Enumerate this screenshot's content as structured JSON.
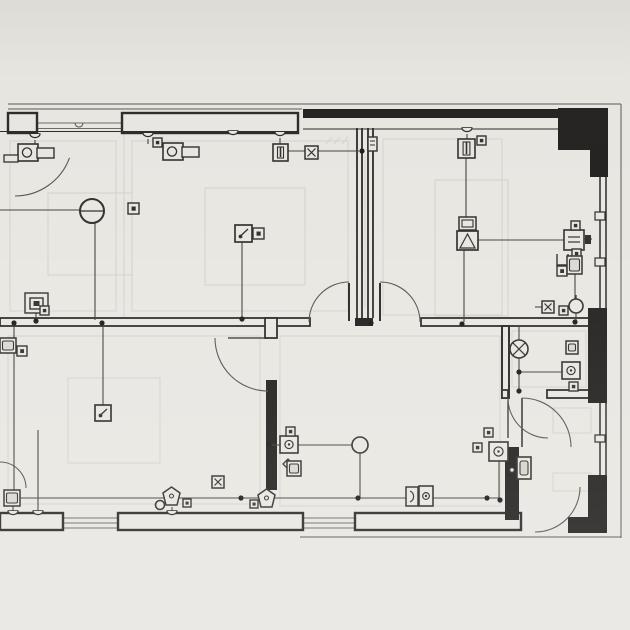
{
  "sheet": {
    "kind": "floor-plan-electrical-drawing",
    "width": 630,
    "height": 630
  },
  "palette": {
    "paper": "#e9e7e2",
    "ink": "#2e2c2a",
    "ink_dark": "#262422",
    "mid": "#5a5854",
    "wire": "#46443f",
    "faint": "#d2d0c9",
    "window": "#6e6c67"
  },
  "plan": {
    "faint_rects": [
      [
        48,
        193,
        84,
        82
      ],
      [
        205,
        188,
        100,
        97
      ],
      [
        435,
        180,
        73,
        136
      ],
      [
        68,
        378,
        92,
        85
      ],
      [
        553,
        408,
        38,
        25
      ],
      [
        553,
        473,
        38,
        18
      ],
      [
        10,
        141,
        106,
        170
      ],
      [
        132,
        141,
        216,
        170
      ],
      [
        383,
        139,
        119,
        176
      ],
      [
        8,
        336,
        252,
        168
      ],
      [
        280,
        336,
        220,
        170
      ],
      [
        512,
        331,
        74,
        56
      ]
    ],
    "faint_lines": [
      [
        124,
        131,
        124,
        318
      ],
      [
        326,
        144,
        332,
        137
      ],
      [
        334,
        144,
        340,
        137
      ],
      [
        342,
        144,
        348,
        137
      ],
      [
        365,
        155,
        365,
        308
      ]
    ],
    "eaves": [
      [
        8,
        104,
        621,
        104
      ],
      [
        8,
        109,
        302,
        109
      ],
      [
        621,
        104,
        621,
        538
      ],
      [
        300,
        537,
        621,
        537
      ]
    ],
    "windows": [
      [
        37,
        123,
        122,
        123
      ],
      [
        37,
        128.5,
        122,
        128.5
      ],
      [
        63,
        518,
        118,
        518
      ],
      [
        63,
        523,
        118,
        523
      ],
      [
        63,
        528,
        118,
        528
      ],
      [
        303,
        518,
        355,
        518
      ],
      [
        303,
        523,
        355,
        523
      ],
      [
        303,
        528,
        355,
        528
      ]
    ],
    "walls_outlined": [
      [
        8,
        113,
        29,
        20,
        2.4
      ],
      [
        122,
        113,
        176,
        20,
        2.4
      ],
      [
        0,
        318,
        310,
        8,
        1.8
      ],
      [
        421,
        318,
        172,
        8,
        1.8
      ],
      [
        265,
        318,
        12,
        20,
        1.8
      ],
      [
        502,
        326,
        7,
        72,
        2.0
      ],
      [
        502,
        390,
        6,
        8,
        1.8
      ],
      [
        547,
        390,
        46,
        8,
        1.8
      ],
      [
        0,
        513,
        63,
        17,
        2.4
      ],
      [
        118,
        513,
        185,
        17,
        2.4
      ],
      [
        355,
        513,
        166,
        17,
        2.4
      ]
    ],
    "walls_dark": [
      [
        303,
        109,
        255,
        9
      ],
      [
        558,
        108,
        50,
        42
      ],
      [
        590,
        150,
        18,
        27
      ],
      [
        588,
        308,
        19,
        95
      ],
      [
        588,
        475,
        19,
        45
      ],
      [
        568,
        517,
        39,
        16
      ],
      [
        505,
        447,
        14,
        73
      ],
      [
        355,
        318,
        18,
        8
      ],
      [
        266,
        380,
        11,
        110
      ]
    ],
    "wall_lines": [
      [
        357,
        128,
        357,
        318,
        1.8
      ],
      [
        362,
        128,
        362,
        318,
        1.8
      ],
      [
        368,
        128,
        368,
        318,
        1.8
      ],
      [
        373,
        128,
        373,
        318,
        1.8
      ],
      [
        600,
        175,
        600,
        308,
        1.5
      ],
      [
        606,
        175,
        606,
        308,
        1.5
      ],
      [
        600,
        403,
        600,
        475,
        1.5
      ],
      [
        606,
        403,
        606,
        475,
        1.5
      ],
      [
        0,
        131.5,
        298,
        131.5,
        1.1
      ],
      [
        303,
        129,
        558,
        129,
        1.1
      ],
      [
        514,
        447,
        514,
        520,
        1.1
      ],
      [
        518,
        447,
        518,
        520,
        1.1
      ],
      [
        522,
        398,
        522,
        447,
        1.5
      ],
      [
        508,
        398,
        508,
        438,
        1.3
      ],
      [
        349,
        283,
        349,
        321,
        2
      ],
      [
        380,
        283,
        380,
        321,
        2
      ],
      [
        228,
        338,
        268,
        338,
        1.3
      ]
    ],
    "doors": [
      {
        "cx": 349,
        "cy": 322,
        "r": 40,
        "a1": 180,
        "a2": 270
      },
      {
        "cx": 380,
        "cy": 322,
        "r": 40,
        "a1": 270,
        "a2": 360
      },
      {
        "cx": 268,
        "cy": 338,
        "r": 53,
        "a1": 90,
        "a2": 180
      },
      {
        "cx": 548,
        "cy": 398,
        "r": 40,
        "a1": 90,
        "a2": 180
      },
      {
        "cx": 522,
        "cy": 447,
        "r": 49,
        "a1": 270,
        "a2": 360
      },
      {
        "cx": 535,
        "cy": 487,
        "r": 45,
        "a1": 0,
        "a2": 90
      },
      {
        "cx": 15,
        "cy": 138,
        "r": 58,
        "a1": 20,
        "a2": 90
      },
      {
        "cx": 0,
        "cy": 488,
        "r": 26,
        "a1": 270,
        "a2": 360
      }
    ],
    "wires": [
      [
        [
          0,
          210
        ],
        [
          80,
          210
        ]
      ],
      [
        [
          95,
          223
        ],
        [
          95,
          320
        ]
      ],
      [
        [
          103,
          324
        ],
        [
          103,
          405
        ]
      ],
      [
        [
          36,
          313
        ],
        [
          36,
          320
        ]
      ],
      [
        [
          14,
          326
        ],
        [
          14,
          490
        ]
      ],
      [
        [
          13,
          506
        ],
        [
          13,
          512
        ]
      ],
      [
        [
          288,
          151
        ],
        [
          305,
          151
        ]
      ],
      [
        [
          318,
          151
        ],
        [
          359,
          151
        ]
      ],
      [
        [
          242,
          242
        ],
        [
          242,
          317
        ]
      ],
      [
        [
          466,
          157
        ],
        [
          466,
          217
        ]
      ],
      [
        [
          464,
          250
        ],
        [
          464,
          322
        ]
      ],
      [
        [
          478,
          240
        ],
        [
          564,
          240
        ]
      ],
      [
        [
          584,
          239
        ],
        [
          592,
          239
        ]
      ],
      [
        [
          575,
          274
        ],
        [
          575,
          300
        ]
      ],
      [
        [
          576,
          313
        ],
        [
          576,
          320
        ]
      ],
      [
        [
          535,
          307
        ],
        [
          542,
          307
        ]
      ],
      [
        [
          519,
          326
        ],
        [
          519,
          341
        ]
      ],
      [
        [
          519,
          358
        ],
        [
          519,
          390
        ]
      ],
      [
        [
          519,
          372
        ],
        [
          562,
          372
        ]
      ],
      [
        [
          499,
          461
        ],
        [
          499,
          498
        ]
      ],
      [
        [
          20,
          498
        ],
        [
          500,
          498
        ]
      ],
      [
        [
          298,
          445
        ],
        [
          352,
          445
        ]
      ],
      [
        [
          282,
          445
        ],
        [
          269,
          445
        ]
      ],
      [
        [
          360,
          453
        ],
        [
          360,
          497
        ]
      ],
      [
        [
          172,
          507
        ],
        [
          172,
          511
        ]
      ],
      [
        [
          35,
          140
        ],
        [
          35,
          145
        ]
      ],
      [
        [
          148,
          139
        ],
        [
          148,
          144
        ]
      ],
      [
        [
          280,
          138
        ],
        [
          280,
          144
        ]
      ],
      [
        [
          467,
          134
        ],
        [
          467,
          140
        ]
      ],
      [
        [
          38,
          430
        ],
        [
          38,
          511
        ]
      ]
    ],
    "dots": [
      [
        14,
        323
      ],
      [
        36,
        321
      ],
      [
        102,
        323
      ],
      [
        242,
        319
      ],
      [
        362,
        151
      ],
      [
        371,
        323
      ],
      [
        462,
        324
      ],
      [
        575,
        322
      ],
      [
        519,
        372
      ],
      [
        519,
        391
      ],
      [
        269,
        444
      ],
      [
        241,
        498
      ],
      [
        358,
        498
      ],
      [
        487,
        498
      ],
      [
        500,
        500
      ]
    ],
    "pucks": [
      [
        35,
        137
      ],
      [
        148,
        136
      ],
      [
        233,
        134
      ],
      [
        280,
        135
      ],
      [
        467,
        131
      ],
      [
        13,
        514
      ],
      [
        38,
        514
      ],
      [
        172,
        514
      ]
    ],
    "triangles": [
      [
        505,
        447,
        517,
        447,
        511,
        459
      ]
    ],
    "ticks": [
      [
        595,
        212,
        10,
        8
      ],
      [
        595,
        258,
        10,
        8
      ],
      [
        595,
        435,
        10,
        7
      ]
    ],
    "bumps": [
      [
        79,
        123
      ]
    ],
    "symbols": [
      {
        "t": "fixture_arm",
        "x": 18,
        "y": 144,
        "bar": true
      },
      {
        "t": "fixture_arm",
        "x": 163,
        "y": 143,
        "bar": false
      },
      {
        "t": "sq_dot",
        "x": 153,
        "y": 138,
        "s": 9
      },
      {
        "t": "circle_lamp",
        "x": 92,
        "y": 211,
        "r": 12
      },
      {
        "t": "sq_dot",
        "x": 128,
        "y": 203,
        "s": 11
      },
      {
        "t": "sq_sq",
        "x": 25,
        "y": 293
      },
      {
        "t": "sq_dot",
        "x": 40,
        "y": 306,
        "s": 9
      },
      {
        "t": "pen_switch",
        "x": 95,
        "y": 405,
        "s": 16
      },
      {
        "t": "pendant",
        "x": 273,
        "y": 144,
        "s": 15
      },
      {
        "t": "sq_x",
        "x": 305,
        "y": 146,
        "s": 13
      },
      {
        "t": "wall_fix",
        "x": 368,
        "y": 137
      },
      {
        "t": "pen_switch",
        "x": 235,
        "y": 225,
        "s": 17
      },
      {
        "t": "sq_dot",
        "x": 253,
        "y": 228,
        "s": 11
      },
      {
        "t": "pendant",
        "x": 458,
        "y": 139,
        "s": 17
      },
      {
        "t": "sq_dot",
        "x": 477,
        "y": 136,
        "s": 9
      },
      {
        "t": "monitor",
        "x": 457,
        "y": 217
      },
      {
        "t": "outlet",
        "x": 564,
        "y": 230,
        "s": 20
      },
      {
        "t": "plug",
        "x": 585,
        "y": 235
      },
      {
        "t": "sq_dot",
        "x": 571,
        "y": 221,
        "s": 9
      },
      {
        "t": "sq_dot",
        "x": 572,
        "y": 249,
        "s": 9
      },
      {
        "t": "u_box",
        "x": 557,
        "y": 254,
        "s": 11
      },
      {
        "t": "sq_dot",
        "x": 557,
        "y": 266,
        "s": 10
      },
      {
        "t": "cab",
        "x": 567,
        "y": 256,
        "w": 15,
        "h": 18
      },
      {
        "t": "circle_stem",
        "x": 576,
        "y": 306,
        "r": 7
      },
      {
        "t": "sq_x",
        "x": 542,
        "y": 301,
        "s": 12
      },
      {
        "t": "sq_dot",
        "x": 559,
        "y": 306,
        "s": 9
      },
      {
        "t": "circle_x",
        "x": 519,
        "y": 349,
        "r": 9
      },
      {
        "t": "box_circle",
        "x": 562,
        "y": 362,
        "w": 18,
        "h": 17
      },
      {
        "t": "cab",
        "x": 566,
        "y": 341,
        "w": 12,
        "h": 13
      },
      {
        "t": "sq_dot",
        "x": 569,
        "y": 382,
        "s": 9
      },
      {
        "t": "box_circle",
        "x": 489,
        "y": 442,
        "w": 19,
        "h": 19
      },
      {
        "t": "sq_dot",
        "x": 473,
        "y": 443,
        "s": 9
      },
      {
        "t": "sq_dot",
        "x": 484,
        "y": 428,
        "s": 9
      },
      {
        "t": "leafbox",
        "x": 517,
        "y": 457
      },
      {
        "t": "circle_plain",
        "x": 512,
        "y": 470,
        "r": 2.5
      },
      {
        "t": "box_circle",
        "x": 280,
        "y": 436,
        "w": 18,
        "h": 17
      },
      {
        "t": "sq_dot",
        "x": 286,
        "y": 427,
        "s": 9
      },
      {
        "t": "circle_plain",
        "x": 360,
        "y": 445,
        "r": 8
      },
      {
        "t": "diamond",
        "x": 283,
        "y": 459,
        "s": 10
      },
      {
        "t": "cab",
        "x": 287,
        "y": 461,
        "w": 14,
        "h": 15
      },
      {
        "t": "sq_x",
        "x": 212,
        "y": 476,
        "s": 12
      },
      {
        "t": "pentagon",
        "x": 258,
        "y": 489
      },
      {
        "t": "sq_dot",
        "x": 250,
        "y": 500,
        "s": 8
      },
      {
        "t": "pentagon",
        "x": 163,
        "y": 487
      },
      {
        "t": "circle_plain",
        "x": 160,
        "y": 505,
        "r": 4.5
      },
      {
        "t": "sq_dot",
        "x": 183,
        "y": 499,
        "s": 8
      },
      {
        "t": "cab",
        "x": 4,
        "y": 490,
        "w": 16,
        "h": 16
      },
      {
        "t": "dfix",
        "x": 406,
        "y": 487
      },
      {
        "t": "box_circle",
        "x": 419,
        "y": 486,
        "w": 14,
        "h": 20
      },
      {
        "t": "cab",
        "x": 0,
        "y": 338,
        "w": 16,
        "h": 15
      },
      {
        "t": "sq_dot",
        "x": 17,
        "y": 346,
        "s": 10
      }
    ]
  }
}
